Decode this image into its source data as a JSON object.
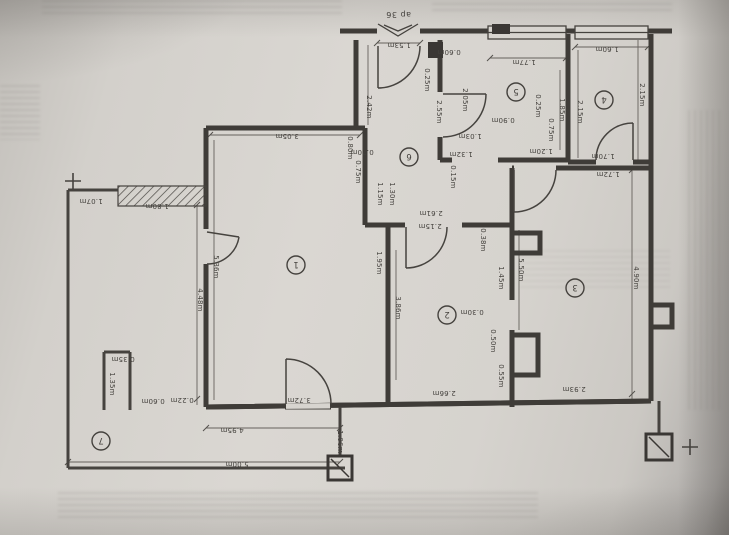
{
  "plan": {
    "apartment_label": "ap 36",
    "colors": {
      "ink": "#45423e",
      "paper": "#d7d4cf"
    },
    "rooms": [
      {
        "id": "1",
        "x": 296,
        "y": 265
      },
      {
        "id": "2",
        "x": 447,
        "y": 315
      },
      {
        "id": "3",
        "x": 575,
        "y": 288
      },
      {
        "id": "4",
        "x": 604,
        "y": 100
      },
      {
        "id": "5",
        "x": 516,
        "y": 92
      },
      {
        "id": "6",
        "x": 409,
        "y": 157
      },
      {
        "id": "7",
        "x": 101,
        "y": 441
      }
    ],
    "dimension_labels": [
      {
        "text": "1.53m",
        "x": 399,
        "y": 43,
        "rot": 180
      },
      {
        "text": "0.25m",
        "x": 425,
        "y": 80,
        "rot": 90
      },
      {
        "text": "2.42m",
        "x": 367,
        "y": 107,
        "rot": 90
      },
      {
        "text": "2.55m",
        "x": 437,
        "y": 112,
        "rot": 90
      },
      {
        "text": "2.05m",
        "x": 463,
        "y": 100,
        "rot": 90
      },
      {
        "text": "0.60m",
        "x": 449,
        "y": 50,
        "rot": 180
      },
      {
        "text": "1.77m",
        "x": 524,
        "y": 60,
        "rot": 180
      },
      {
        "text": "1.60m",
        "x": 607,
        "y": 47,
        "rot": 180
      },
      {
        "text": "2.15m",
        "x": 578,
        "y": 112,
        "rot": 90
      },
      {
        "text": "2.15m",
        "x": 640,
        "y": 95,
        "rot": 90
      },
      {
        "text": "1.85m",
        "x": 560,
        "y": 110,
        "rot": 90
      },
      {
        "text": "0.25m",
        "x": 536,
        "y": 106,
        "rot": 90
      },
      {
        "text": "0.90m",
        "x": 503,
        "y": 118,
        "rot": 180
      },
      {
        "text": "1.03m",
        "x": 470,
        "y": 134,
        "rot": 180
      },
      {
        "text": "0.75m",
        "x": 549,
        "y": 130,
        "rot": 90
      },
      {
        "text": "1.32m",
        "x": 461,
        "y": 152,
        "rot": 180
      },
      {
        "text": "1.20m",
        "x": 541,
        "y": 149,
        "rot": 180
      },
      {
        "text": "0.15m",
        "x": 451,
        "y": 177,
        "rot": 90
      },
      {
        "text": "1.70m",
        "x": 603,
        "y": 154,
        "rot": 180
      },
      {
        "text": "1.72m",
        "x": 608,
        "y": 172,
        "rot": 180
      },
      {
        "text": "3.05m",
        "x": 287,
        "y": 134,
        "rot": 180
      },
      {
        "text": "0.80m",
        "x": 348,
        "y": 148,
        "rot": 90
      },
      {
        "text": "0.70m",
        "x": 362,
        "y": 150,
        "rot": 180
      },
      {
        "text": "0.75m",
        "x": 356,
        "y": 172,
        "rot": 90
      },
      {
        "text": "1.15m",
        "x": 378,
        "y": 194,
        "rot": 90
      },
      {
        "text": "1.30m",
        "x": 390,
        "y": 194,
        "rot": 90
      },
      {
        "text": "1.95m",
        "x": 377,
        "y": 263,
        "rot": 90
      },
      {
        "text": "5.36m",
        "x": 214,
        "y": 267,
        "rot": 90
      },
      {
        "text": "2.61m",
        "x": 431,
        "y": 211,
        "rot": 180
      },
      {
        "text": "2.15m",
        "x": 430,
        "y": 224,
        "rot": 180
      },
      {
        "text": "3.86m",
        "x": 396,
        "y": 308,
        "rot": 90
      },
      {
        "text": "0.38m",
        "x": 481,
        "y": 240,
        "rot": 90
      },
      {
        "text": "1.45m",
        "x": 499,
        "y": 278,
        "rot": 90
      },
      {
        "text": "0.30m",
        "x": 472,
        "y": 310,
        "rot": 180
      },
      {
        "text": "0.50m",
        "x": 491,
        "y": 341,
        "rot": 90
      },
      {
        "text": "0.55m",
        "x": 499,
        "y": 376,
        "rot": 90
      },
      {
        "text": "5.50m",
        "x": 519,
        "y": 270,
        "rot": 90
      },
      {
        "text": "2.66m",
        "x": 444,
        "y": 391,
        "rot": 180
      },
      {
        "text": "2.93m",
        "x": 574,
        "y": 387,
        "rot": 180
      },
      {
        "text": "4.90m",
        "x": 634,
        "y": 278,
        "rot": 90
      },
      {
        "text": "3.72m",
        "x": 299,
        "y": 398,
        "rot": 180
      },
      {
        "text": "1.07m",
        "x": 91,
        "y": 199,
        "rot": 180
      },
      {
        "text": "1.80m",
        "x": 157,
        "y": 204,
        "rot": 180
      },
      {
        "text": "4.48m",
        "x": 198,
        "y": 300,
        "rot": 90
      },
      {
        "text": "1.35m",
        "x": 110,
        "y": 384,
        "rot": 90
      },
      {
        "text": "0.35m",
        "x": 123,
        "y": 357,
        "rot": 180
      },
      {
        "text": "0.60m",
        "x": 153,
        "y": 399,
        "rot": 180
      },
      {
        "text": "0.22m",
        "x": 182,
        "y": 398,
        "rot": 180
      },
      {
        "text": "4.95m",
        "x": 232,
        "y": 428,
        "rot": 180
      },
      {
        "text": "5.00m",
        "x": 237,
        "y": 462,
        "rot": 180
      },
      {
        "text": "1.06m",
        "x": 338,
        "y": 442,
        "rot": 90
      }
    ]
  }
}
